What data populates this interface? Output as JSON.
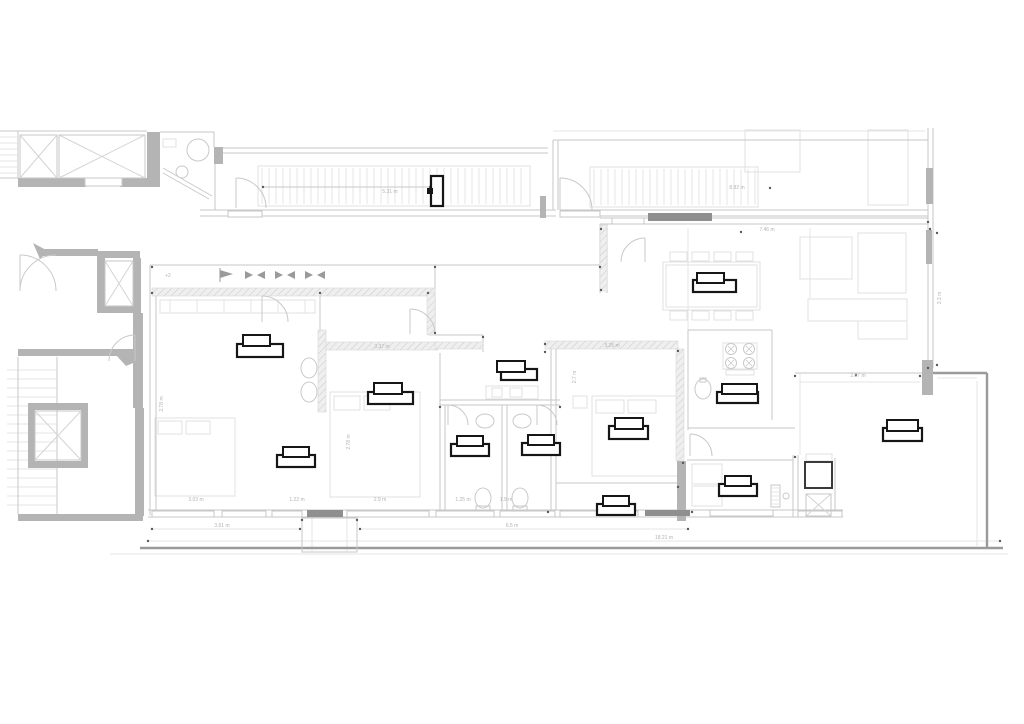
{
  "meta": {
    "drawing_type": "architectural-floor-plan",
    "level_mark": "+2"
  },
  "canvas": {
    "w": 1024,
    "h": 724,
    "bg": "#ffffff"
  },
  "colors": {
    "wall": "#b4b4b4",
    "wall_dark": "#8f8f8f",
    "line": "#c7c7c7",
    "line_strong": "#9a9a9a",
    "line_faint": "#e6e6e6",
    "fixture": "#c9c9c9",
    "xmark": "#d4d4d4",
    "marker": "#161616",
    "dim_text": "#b3b3b3",
    "dot": "#5a5a5a",
    "arrow": "#9a9a9a",
    "furniture": "#e0e0e0",
    "dark_square": "#3a3a3a"
  },
  "walls_solid": [
    [
      147,
      132,
      13,
      52
    ],
    [
      18,
      178,
      68,
      9
    ],
    [
      120,
      178,
      40,
      9
    ],
    [
      214,
      147,
      9,
      17
    ],
    [
      97,
      251,
      8,
      62
    ],
    [
      105,
      251,
      35,
      7
    ],
    [
      133,
      258,
      8,
      55
    ],
    [
      105,
      306,
      33,
      7
    ],
    [
      40,
      249,
      58,
      7
    ],
    [
      133,
      313,
      10,
      95
    ],
    [
      18,
      349,
      125,
      7
    ],
    [
      135,
      408,
      9,
      108
    ],
    [
      28,
      403,
      60,
      7
    ],
    [
      28,
      461,
      60,
      7
    ],
    [
      28,
      403,
      7,
      65
    ],
    [
      81,
      403,
      7,
      65
    ],
    [
      18,
      514,
      125,
      7
    ],
    [
      540,
      196,
      6,
      22
    ],
    [
      922,
      360,
      11,
      35
    ],
    [
      677,
      461,
      9,
      60
    ],
    [
      926,
      168,
      7,
      36
    ],
    [
      926,
      230,
      6,
      34
    ]
  ],
  "walls_dark": [
    [
      648,
      213,
      64,
      8
    ],
    [
      307,
      510,
      36,
      7
    ],
    [
      645,
      510,
      45,
      6
    ]
  ],
  "hatch_bands": [
    [
      152,
      288,
      283,
      8
    ],
    [
      427,
      293,
      8,
      42
    ],
    [
      318,
      330,
      8,
      82
    ],
    [
      326,
      342,
      112,
      8
    ],
    [
      600,
      225,
      7,
      66
    ],
    [
      545,
      341,
      133,
      8
    ],
    [
      676,
      349,
      8,
      112
    ],
    [
      435,
      342,
      48,
      7
    ]
  ],
  "window_sills": [
    [
      228,
      211,
      34,
      6
    ],
    [
      560,
      211,
      40,
      6
    ],
    [
      85,
      178,
      37,
      8
    ],
    [
      612,
      218,
      32,
      6
    ],
    [
      152,
      511,
      62,
      6
    ],
    [
      222,
      511,
      44,
      6
    ],
    [
      272,
      511,
      30,
      6
    ],
    [
      347,
      511,
      82,
      6
    ],
    [
      436,
      511,
      58,
      6
    ],
    [
      500,
      511,
      55,
      6
    ],
    [
      560,
      511,
      78,
      6
    ],
    [
      710,
      510,
      63,
      6
    ],
    [
      798,
      511,
      44,
      6
    ]
  ],
  "outline_rects": [
    [
      20,
      135,
      37,
      43
    ],
    [
      59,
      135,
      86,
      43
    ],
    [
      105,
      261,
      28,
      45
    ],
    [
      35,
      411,
      46,
      49
    ],
    [
      302,
      518,
      55,
      34
    ],
    [
      476,
      506,
      14,
      5
    ],
    [
      513,
      506,
      14,
      5
    ],
    [
      771,
      485,
      9,
      22
    ]
  ],
  "furniture_rects": [
    [
      155,
      418,
      80,
      78
    ],
    [
      158,
      421,
      24,
      13
    ],
    [
      186,
      421,
      24,
      13
    ],
    [
      330,
      392,
      90,
      105
    ],
    [
      334,
      396,
      26,
      14
    ],
    [
      364,
      396,
      26,
      14
    ],
    [
      592,
      396,
      90,
      80
    ],
    [
      596,
      400,
      28,
      13
    ],
    [
      628,
      400,
      28,
      13
    ],
    [
      573,
      396,
      14,
      12
    ],
    [
      663,
      262,
      97,
      48
    ],
    [
      666,
      265,
      91,
      42
    ],
    [
      670,
      252,
      17,
      9
    ],
    [
      692,
      252,
      17,
      9
    ],
    [
      714,
      252,
      17,
      9
    ],
    [
      736,
      252,
      17,
      9
    ],
    [
      670,
      311,
      17,
      9
    ],
    [
      692,
      311,
      17,
      9
    ],
    [
      714,
      311,
      17,
      9
    ],
    [
      736,
      311,
      17,
      9
    ],
    [
      808,
      299,
      99,
      22
    ],
    [
      858,
      321,
      49,
      18
    ],
    [
      858,
      233,
      48,
      60
    ],
    [
      800,
      237,
      52,
      42
    ],
    [
      486,
      386,
      52,
      13
    ],
    [
      492,
      388,
      10,
      9
    ],
    [
      510,
      388,
      12,
      9
    ],
    [
      692,
      464,
      30,
      20
    ],
    [
      692,
      486,
      30,
      20
    ],
    [
      745,
      130,
      55,
      42
    ],
    [
      868,
      130,
      40,
      75
    ],
    [
      258,
      166,
      272,
      40
    ],
    [
      590,
      167,
      168,
      40
    ],
    [
      160,
      300,
      155,
      13
    ],
    [
      723,
      343,
      34,
      26
    ],
    [
      726,
      370,
      28,
      5
    ],
    [
      806,
      454,
      26,
      7
    ],
    [
      163,
      139,
      13,
      8
    ]
  ],
  "lines": {
    "thin": [
      [
        0,
        131,
        147,
        131
      ],
      [
        18,
        131,
        18,
        178
      ],
      [
        0,
        178,
        18,
        178
      ],
      [
        57,
        135,
        57,
        178
      ],
      [
        160,
        132,
        214,
        132
      ],
      [
        214,
        132,
        214,
        147
      ],
      [
        215,
        148,
        548,
        148
      ],
      [
        215,
        153,
        548,
        153
      ],
      [
        215,
        153,
        215,
        210
      ],
      [
        200,
        210,
        556,
        210
      ],
      [
        200,
        216,
        556,
        216
      ],
      [
        553,
        140,
        553,
        210
      ],
      [
        558,
        140,
        558,
        210
      ],
      [
        553,
        140,
        928,
        140
      ],
      [
        560,
        210,
        928,
        210
      ],
      [
        560,
        216,
        928,
        216
      ],
      [
        928,
        128,
        928,
        368
      ],
      [
        933,
        128,
        933,
        368
      ],
      [
        600,
        218,
        928,
        218
      ],
      [
        600,
        224,
        928,
        224
      ],
      [
        600,
        224,
        600,
        293
      ],
      [
        607,
        224,
        607,
        293
      ],
      [
        150,
        265,
        600,
        265
      ],
      [
        150,
        265,
        150,
        515
      ],
      [
        156,
        296,
        156,
        512
      ],
      [
        435,
        265,
        435,
        293
      ],
      [
        435,
        293,
        435,
        335
      ],
      [
        320,
        296,
        320,
        330
      ],
      [
        430,
        335,
        483,
        335
      ],
      [
        483,
        335,
        483,
        352
      ],
      [
        440,
        353,
        440,
        510
      ],
      [
        445,
        405,
        445,
        510
      ],
      [
        502,
        405,
        502,
        510
      ],
      [
        507,
        405,
        507,
        510
      ],
      [
        440,
        400,
        560,
        400
      ],
      [
        440,
        405,
        560,
        405
      ],
      [
        551,
        348,
        551,
        510
      ],
      [
        556,
        348,
        556,
        510
      ],
      [
        556,
        483,
        678,
        483
      ],
      [
        148,
        510,
        692,
        510
      ],
      [
        148,
        517,
        692,
        517
      ],
      [
        687,
        460,
        793,
        460
      ],
      [
        793,
        455,
        793,
        517
      ],
      [
        798,
        455,
        798,
        517
      ],
      [
        687,
        510,
        843,
        510
      ],
      [
        687,
        517,
        843,
        517
      ],
      [
        835,
        458,
        835,
        517
      ],
      [
        688,
        330,
        772,
        330
      ],
      [
        688,
        330,
        688,
        430
      ],
      [
        772,
        330,
        772,
        420
      ],
      [
        688,
        428,
        795,
        428
      ],
      [
        795,
        373,
        922,
        373
      ],
      [
        57,
        357,
        57,
        514
      ],
      [
        18,
        357,
        18,
        514
      ],
      [
        263,
        187,
        432,
        187
      ]
    ],
    "strong": [
      [
        140,
        548,
        1003,
        548
      ],
      [
        987,
        373,
        987,
        548
      ],
      [
        933,
        373,
        987,
        373
      ]
    ],
    "faint": [
      [
        553,
        131,
        925,
        131
      ],
      [
        688,
        228,
        688,
        330
      ],
      [
        810,
        228,
        810,
        298
      ],
      [
        800,
        382,
        920,
        382
      ],
      [
        800,
        373,
        800,
        455
      ],
      [
        937,
        378,
        977,
        378
      ],
      [
        977,
        381,
        977,
        546
      ],
      [
        312,
        518,
        312,
        551
      ],
      [
        347,
        518,
        347,
        551
      ],
      [
        148,
        541,
        1000,
        541
      ],
      [
        150,
        529,
        300,
        529
      ],
      [
        360,
        529,
        688,
        529
      ],
      [
        110,
        554,
        1008,
        554
      ]
    ]
  },
  "line_series": [
    {
      "dir": "v",
      "from": 262,
      "to": 527,
      "step": 7,
      "a": 168,
      "b": 204
    },
    {
      "dir": "v",
      "from": 594,
      "to": 756,
      "step": 7,
      "a": 169,
      "b": 205
    },
    {
      "dir": "h",
      "from": 370,
      "to": 512,
      "step": 9,
      "a": 7,
      "b": 57
    },
    {
      "dir": "h",
      "from": 137,
      "to": 176,
      "step": 6,
      "a": 0,
      "b": 17
    },
    {
      "dir": "h",
      "from": 488,
      "to": 504,
      "step": 4,
      "a": 772,
      "b": 779
    },
    {
      "dir": "v",
      "from": 170,
      "to": 305,
      "step": 27,
      "a": 300,
      "b": 313
    }
  ],
  "ellipses": [
    [
      198,
      150,
      11,
      11
    ],
    [
      182,
      172,
      6,
      6
    ],
    [
      309,
      368,
      8,
      10
    ],
    [
      309,
      392,
      8,
      10
    ],
    [
      485,
      421,
      9,
      7
    ],
    [
      522,
      421,
      9,
      7
    ],
    [
      483,
      498,
      8,
      10
    ],
    [
      520,
      498,
      8,
      10
    ],
    [
      703,
      389,
      8,
      10
    ],
    [
      786,
      496,
      3,
      3
    ]
  ],
  "burners": {
    "centers": [
      [
        731,
        349
      ],
      [
        749,
        349
      ],
      [
        731,
        363
      ],
      [
        749,
        363
      ]
    ],
    "r": 5.5
  },
  "paths": {
    "fixture": [
      "M163,168 L212,196",
      "M163,173 L209,199",
      "M236,178 A30 30 0 0 1 266,208",
      "M236,178 L236,208",
      "M560,178 A32 32 0 0 1 592,210",
      "M560,178 L560,210",
      "M20,255 A36 36 0 0 1 56,291",
      "M20,255 L20,291",
      "M56,255 A36 36 0 0 0 20,291",
      "M410,309 A25 25 0 0 1 435,334",
      "M410,309 L410,334",
      "M448,405 A20 20 0 0 1 468,425",
      "M448,405 L448,425",
      "M537,405 A20 20 0 0 1 557,425",
      "M537,405 L537,425",
      "M621,262 A24 24 0 0 1 645,238",
      "M645,238 L645,262",
      "M690,434 A22 22 0 0 1 712,456",
      "M690,434 L690,456",
      "M262,296 A26 26 0 0 1 288,322",
      "M262,296 L262,322",
      "M135,335 A26 26 0 0 0 109,361",
      "M135,335 L135,361",
      "M700,378 l6,0 l0,4 l-6,0 Z"
    ],
    "xmarks": [
      "M20,135 L57,178 M57,135 L20,178",
      "M59,135 L145,178 M145,135 L59,178",
      "M105,261 L133,306 M133,261 L105,306",
      "M35,411 L81,460 M81,411 L35,460",
      "M806,494 L831,516 M831,494 L806,516"
    ]
  },
  "polygons": [
    {
      "points": "33,243 48,251 40,259"
    },
    {
      "points": "116,355 130,349 140,360 126,366"
    }
  ],
  "dark_square": [
    805,
    462,
    27,
    26
  ],
  "planter_rect": [
    806,
    494,
    25,
    22
  ],
  "flag": {
    "tri": "220,270 233,274 220,278",
    "stem": [
      220,
      268,
      220,
      282
    ]
  },
  "arrow_pairs": [
    [
      245,
      275
    ],
    [
      275,
      275
    ],
    [
      305,
      275
    ]
  ],
  "dots": [
    [
      152,
      267
    ],
    [
      435,
      267
    ],
    [
      600,
      267
    ],
    [
      152,
      293
    ],
    [
      320,
      293
    ],
    [
      428,
      293
    ],
    [
      435,
      333
    ],
    [
      483,
      337
    ],
    [
      545,
      344
    ],
    [
      678,
      351
    ],
    [
      152,
      529
    ],
    [
      300,
      529
    ],
    [
      360,
      529
    ],
    [
      688,
      529
    ],
    [
      148,
      541
    ],
    [
      1000,
      541
    ],
    [
      263,
      187
    ],
    [
      430,
      187
    ],
    [
      601,
      229
    ],
    [
      930,
      229
    ],
    [
      937,
      233
    ],
    [
      937,
      365
    ],
    [
      795,
      376
    ],
    [
      920,
      376
    ],
    [
      856,
      375
    ],
    [
      601,
      290
    ],
    [
      928,
      222
    ],
    [
      928,
      368
    ],
    [
      795,
      457
    ],
    [
      683,
      463
    ],
    [
      545,
      352
    ],
    [
      440,
      407
    ],
    [
      560,
      407
    ],
    [
      678,
      487
    ],
    [
      548,
      512
    ],
    [
      692,
      512
    ],
    [
      302,
      520
    ],
    [
      357,
      520
    ],
    [
      741,
      232
    ],
    [
      770,
      188
    ]
  ],
  "markers": [
    {
      "t": [
        243,
        335,
        27,
        11
      ],
      "b": [
        237,
        344,
        46,
        13
      ]
    },
    {
      "t": [
        374,
        383,
        28,
        11
      ],
      "b": [
        368,
        392,
        45,
        12
      ]
    },
    {
      "t": [
        497,
        361,
        28,
        11
      ],
      "b": [
        501,
        369,
        36,
        11
      ]
    },
    {
      "t": [
        283,
        447,
        26,
        10
      ],
      "b": [
        277,
        455,
        38,
        12
      ]
    },
    {
      "t": [
        457,
        436,
        26,
        10
      ],
      "b": [
        451,
        444,
        38,
        12
      ]
    },
    {
      "t": [
        528,
        435,
        26,
        10
      ],
      "b": [
        522,
        443,
        38,
        12
      ]
    },
    {
      "t": [
        615,
        418,
        28,
        11
      ],
      "b": [
        609,
        426,
        39,
        13
      ]
    },
    {
      "t": [
        603,
        496,
        26,
        10
      ],
      "b": [
        597,
        504,
        38,
        11
      ]
    },
    {
      "t": [
        725,
        476,
        26,
        10
      ],
      "b": [
        719,
        484,
        38,
        12
      ]
    },
    {
      "t": [
        722,
        384,
        35,
        10
      ],
      "b": [
        717,
        392,
        41,
        11
      ]
    },
    {
      "t": [
        697,
        273,
        27,
        10
      ],
      "b": [
        693,
        280,
        43,
        12
      ]
    },
    {
      "t": [
        887,
        420,
        31,
        11
      ],
      "b": [
        883,
        428,
        39,
        13
      ]
    }
  ],
  "marker_vertical": {
    "rect": [
      431,
      176,
      12,
      30
    ],
    "knob": [
      427,
      188,
      6,
      6
    ]
  },
  "dims": [
    {
      "x": 390,
      "y": 193,
      "t": "5.31 m"
    },
    {
      "x": 737,
      "y": 189,
      "t": "8.82 m"
    },
    {
      "x": 767,
      "y": 231,
      "t": "7.46 m"
    },
    {
      "x": 382,
      "y": 348,
      "t": "3.37 m"
    },
    {
      "x": 612,
      "y": 347,
      "t": "3.25 m"
    },
    {
      "x": 222,
      "y": 527,
      "t": "3.61 m"
    },
    {
      "x": 512,
      "y": 527,
      "t": "6.5 m"
    },
    {
      "x": 664,
      "y": 539,
      "t": "18.21 m"
    },
    {
      "x": 941,
      "y": 298,
      "t": "3.3 m",
      "r": -90
    },
    {
      "x": 858,
      "y": 377,
      "t": "2.87 m"
    },
    {
      "x": 196,
      "y": 501,
      "t": "3.03 m"
    },
    {
      "x": 297,
      "y": 501,
      "t": "1.22 m"
    },
    {
      "x": 380,
      "y": 501,
      "t": "2.9 m"
    },
    {
      "x": 463,
      "y": 501,
      "t": "1.25 m"
    },
    {
      "x": 506,
      "y": 501,
      "t": "1.9 m"
    },
    {
      "x": 163,
      "y": 404,
      "t": "2.78 m",
      "r": -90
    },
    {
      "x": 350,
      "y": 442,
      "t": "2.78 m",
      "r": -90
    },
    {
      "x": 576,
      "y": 377,
      "t": "2.7 m",
      "r": -90
    },
    {
      "x": 168,
      "y": 277,
      "t": "+2"
    }
  ]
}
